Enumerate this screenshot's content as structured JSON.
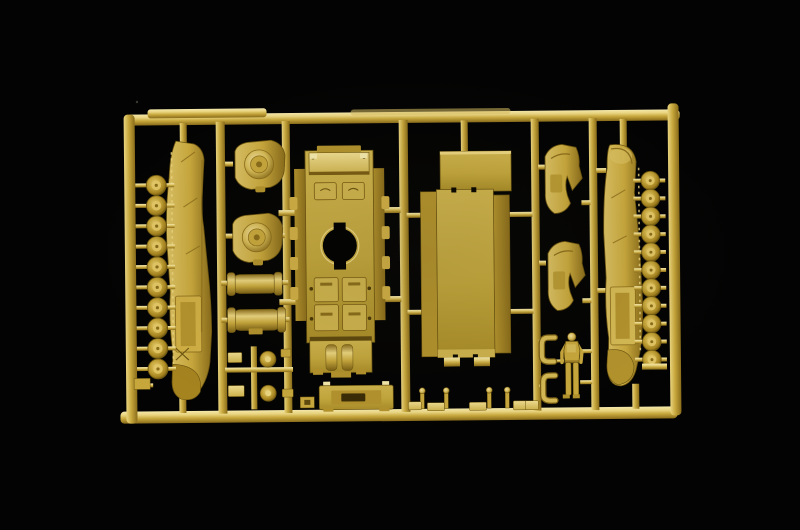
{
  "scene": {
    "type": "photograph",
    "subject": "plastic model kit sprue",
    "description": "Injection-molded dark-yellow (desert tan) sprue of a small-scale military tank model kit photographed on a black background. The rectangular runner frame holds two track runs, two banks of road wheels, drive sprocket housings, cylindrical fuel tanks, an upper hull with a round turret-ring opening, a large flat hull floor panel, curved fender pieces, a rear plate, exhaust pipes, small fittings and a standing crew figure.",
    "background_color": "#030303"
  },
  "colors": {
    "background": "#030303",
    "plastic_base": "#c7a73c",
    "plastic_light": "#e9d47f",
    "plastic_lighter": "#f4e8ab",
    "plastic_mid": "#b2922c",
    "plastic_dark": "#8a6c1a",
    "plastic_deep": "#5e490e",
    "hole_black": "#000000"
  },
  "sprue": {
    "frame_shape": "rectangle",
    "material": "tan polystyrene",
    "parts": [
      {
        "name": "track-run-left",
        "label": "left track run",
        "count": 1
      },
      {
        "name": "road-wheels-left",
        "label": "road wheels (left bank)",
        "count": 10
      },
      {
        "name": "sprocket-housings",
        "label": "drive sprocket housings",
        "count": 2
      },
      {
        "name": "fuel-tanks",
        "label": "cylindrical fuel tanks",
        "count": 2
      },
      {
        "name": "small-wheel-caps",
        "label": "small spare wheels / hub caps",
        "count": 2
      },
      {
        "name": "upper-hull",
        "label": "upper hull with turret-ring opening",
        "count": 1
      },
      {
        "name": "hull-floor-panel",
        "label": "flat hull floor panel",
        "count": 1
      },
      {
        "name": "rear-plate",
        "label": "rear hull plate with hatch",
        "count": 1
      },
      {
        "name": "fender-pieces",
        "label": "curved fender / guard pieces",
        "count": 2
      },
      {
        "name": "track-run-right",
        "label": "right track run",
        "count": 1
      },
      {
        "name": "road-wheels-right",
        "label": "road wheels (right bank)",
        "count": 11
      },
      {
        "name": "exhaust-pipes",
        "label": "L-shaped exhaust pipes",
        "count": 2
      },
      {
        "name": "crew-figure",
        "label": "standing tank crewman figure",
        "count": 1
      },
      {
        "name": "periscope-pins",
        "label": "small periscope / bolt pins",
        "count": 4
      },
      {
        "name": "small-blocks",
        "label": "small fittings and blocks",
        "count": 8
      }
    ]
  }
}
